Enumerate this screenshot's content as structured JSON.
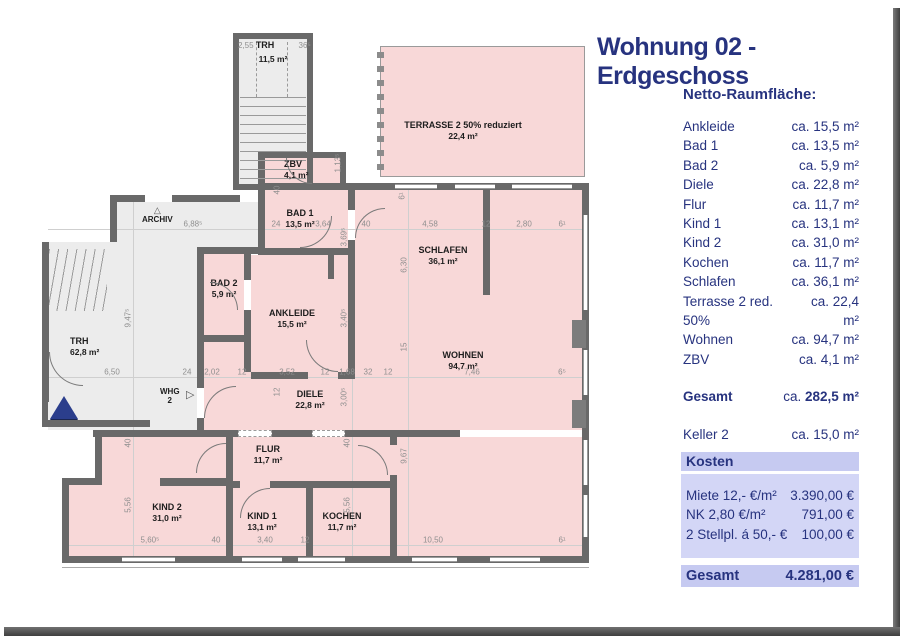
{
  "title": "Wohnung 02 - Erdgeschoss",
  "panel": {
    "subtitle": "Netto-Raumfläche:",
    "rooms": [
      {
        "label": "Ankleide",
        "value": "ca. 15,5 m²"
      },
      {
        "label": "Bad 1",
        "value": "ca. 13,5 m²"
      },
      {
        "label": "Bad 2",
        "value": "ca.  5,9 m²"
      },
      {
        "label": "Diele",
        "value": "ca. 22,8 m²"
      },
      {
        "label": "Flur",
        "value": "ca. 11,7 m²"
      },
      {
        "label": "Kind 1",
        "value": "ca. 13,1 m²"
      },
      {
        "label": "Kind 2",
        "value": "ca. 31,0 m²"
      },
      {
        "label": "Kochen",
        "value": "ca. 11,7 m²"
      },
      {
        "label": "Schlafen",
        "value": "ca. 36,1 m²"
      },
      {
        "label": "Terrasse 2 red. 50%",
        "value": "ca. 22,4 m²"
      },
      {
        "label": "Wohnen",
        "value": "ca. 94,7 m²"
      },
      {
        "label": "ZBV",
        "value": "ca.  4,1 m²"
      }
    ],
    "total": {
      "label": "Gesamt",
      "ca": "ca. ",
      "value": "282,5 m²"
    },
    "keller": {
      "label": "Keller 2",
      "value": "ca. 15,0 m²"
    },
    "kosten": {
      "header": "Kosten",
      "rows": [
        {
          "label": "Miete 12,- €/m²",
          "value": "3.390,00 €"
        },
        {
          "label": "NK 2,80 €/m²",
          "value": "791,00 €"
        },
        {
          "label": "2 Stellpl. á 50,- €",
          "value": "100,00 €"
        }
      ],
      "total": {
        "label": "Gesamt",
        "value": "4.281,00 €"
      }
    }
  },
  "plan": {
    "stairwell": {
      "dim_left": "2,55",
      "name": "TRH",
      "dim_right": "36⁵",
      "area": "11,5 m²"
    },
    "markers": {
      "archiv": "ARCHIV",
      "whg_line1": "WHG",
      "whg_line2": "2",
      "up_triangle_glyph": "△",
      "right_triangle_glyph": "▷"
    },
    "rooms": [
      {
        "name": "TERRASSE 2 50% reduziert",
        "area": "22,4 m²",
        "x": 463,
        "y": 120
      },
      {
        "name": "ZBV",
        "area": "4,1 m²",
        "x": 284,
        "y": 159,
        "align": "left"
      },
      {
        "name": "BAD 1",
        "area": "13,5 m²",
        "x": 300,
        "y": 208
      },
      {
        "name": "SCHLAFEN",
        "area": "36,1 m²",
        "x": 443,
        "y": 245
      },
      {
        "name": "BAD 2",
        "area": "5,9 m²",
        "x": 224,
        "y": 278
      },
      {
        "name": "ANKLEIDE",
        "area": "15,5 m²",
        "x": 292,
        "y": 308
      },
      {
        "name": "TRH",
        "area": "62,8 m²",
        "x": 70,
        "y": 336,
        "align": "left"
      },
      {
        "name": "WOHNEN",
        "area": "94,7 m²",
        "x": 463,
        "y": 350
      },
      {
        "name": "DIELE",
        "area": "22,8 m²",
        "x": 310,
        "y": 389
      },
      {
        "name": "FLUR",
        "area": "11,7 m²",
        "x": 268,
        "y": 444
      },
      {
        "name": "KIND 2",
        "area": "31,0 m²",
        "x": 167,
        "y": 502
      },
      {
        "name": "KIND 1",
        "area": "13,1 m²",
        "x": 262,
        "y": 511
      },
      {
        "name": "KOCHEN",
        "area": "11,7 m²",
        "x": 342,
        "y": 511
      }
    ],
    "dims": [
      {
        "t": "6,88⁵",
        "x": 193,
        "y": 224
      },
      {
        "t": "24",
        "x": 276,
        "y": 224
      },
      {
        "t": "3,64",
        "x": 323,
        "y": 224
      },
      {
        "t": "40",
        "x": 366,
        "y": 224
      },
      {
        "t": "4,58",
        "x": 430,
        "y": 224
      },
      {
        "t": "12",
        "x": 486,
        "y": 224
      },
      {
        "t": "2,80",
        "x": 524,
        "y": 224
      },
      {
        "t": "6¹",
        "x": 562,
        "y": 224
      },
      {
        "t": "6,50",
        "x": 112,
        "y": 372
      },
      {
        "t": "24",
        "x": 187,
        "y": 372
      },
      {
        "t": "2,02",
        "x": 212,
        "y": 372
      },
      {
        "t": "12",
        "x": 242,
        "y": 372
      },
      {
        "t": "3,52",
        "x": 287,
        "y": 372
      },
      {
        "t": "12",
        "x": 325,
        "y": 372
      },
      {
        "t": "1,68",
        "x": 347,
        "y": 372
      },
      {
        "t": "32",
        "x": 368,
        "y": 372
      },
      {
        "t": "12",
        "x": 388,
        "y": 372
      },
      {
        "t": "7,46",
        "x": 472,
        "y": 372
      },
      {
        "t": "6⁵",
        "x": 562,
        "y": 372
      },
      {
        "t": "5,60⁵",
        "x": 150,
        "y": 540
      },
      {
        "t": "40",
        "x": 216,
        "y": 540
      },
      {
        "t": "3,40",
        "x": 265,
        "y": 540
      },
      {
        "t": "12",
        "x": 305,
        "y": 540
      },
      {
        "t": "10,50",
        "x": 433,
        "y": 540
      },
      {
        "t": "6¹",
        "x": 562,
        "y": 540
      },
      {
        "t": "9,47⁵",
        "x": 128,
        "y": 318,
        "v": true
      },
      {
        "t": "40",
        "x": 128,
        "y": 443,
        "v": true
      },
      {
        "t": "5,56",
        "x": 128,
        "y": 505,
        "v": true
      },
      {
        "t": "40",
        "x": 347,
        "y": 443,
        "v": true
      },
      {
        "t": "5,56",
        "x": 347,
        "y": 505,
        "v": true
      },
      {
        "t": "6,30",
        "x": 404,
        "y": 265,
        "v": true
      },
      {
        "t": "15",
        "x": 404,
        "y": 347,
        "v": true
      },
      {
        "t": "9,67",
        "x": 404,
        "y": 456,
        "v": true
      },
      {
        "t": "3,40⁵",
        "x": 344,
        "y": 318,
        "v": true
      },
      {
        "t": "3,00⁵",
        "x": 344,
        "y": 397,
        "v": true
      },
      {
        "t": "1,13⁵",
        "x": 338,
        "y": 163,
        "v": true
      },
      {
        "t": "3,69⁵",
        "x": 344,
        "y": 237,
        "v": true
      },
      {
        "t": "12",
        "x": 277,
        "y": 392,
        "v": true
      },
      {
        "t": "40",
        "x": 277,
        "y": 190,
        "v": true
      },
      {
        "t": "6¹",
        "x": 402,
        "y": 196,
        "v": true
      }
    ]
  },
  "colors": {
    "navy": "#27337f",
    "room_pink": "#f8d8d8",
    "floor_gray": "#ececec",
    "wall": "#696969",
    "kosten_box": "#c6caf1",
    "kosten_box_light": "#d3d6f6",
    "frame": "#4e4e4e",
    "entrance_triangle": "#2b3e8c"
  }
}
